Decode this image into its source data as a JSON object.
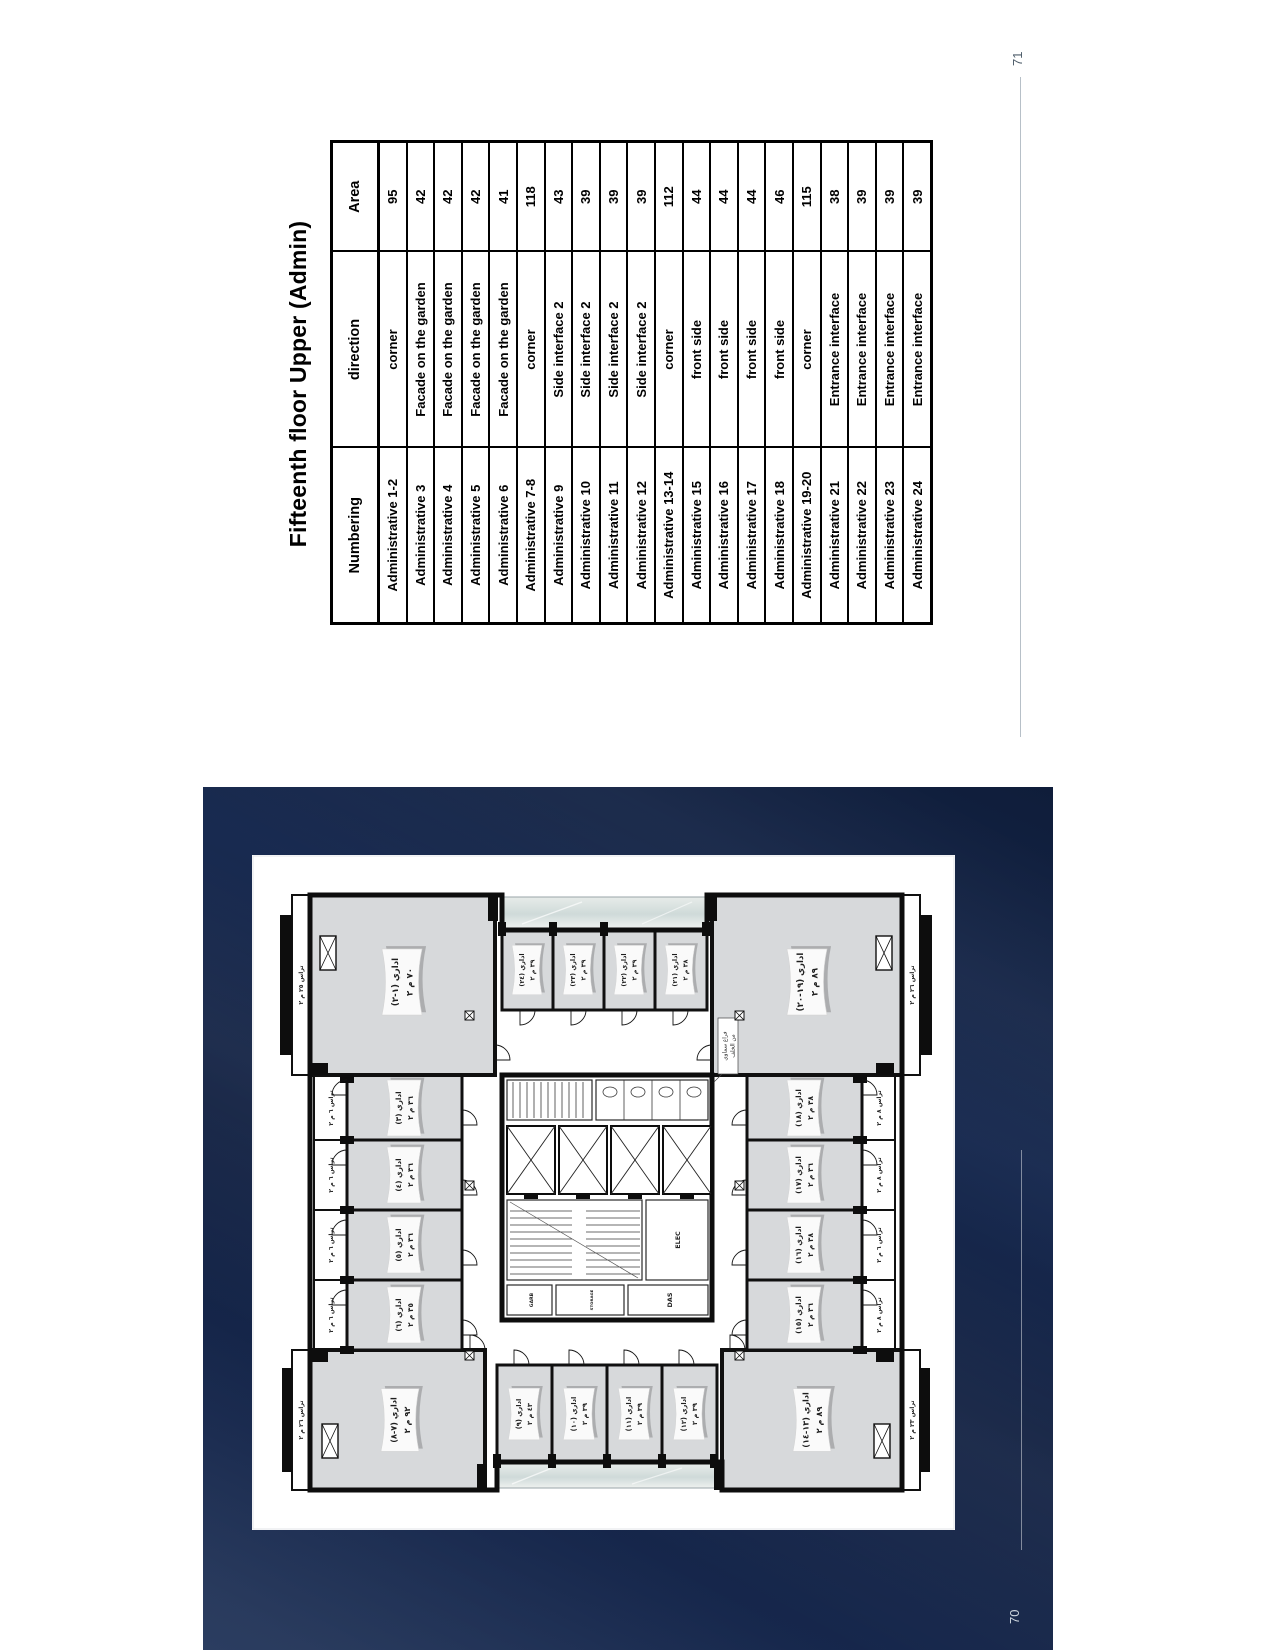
{
  "page71": {
    "page_number": "71",
    "title": "Fifteenth floor Upper (Admin)",
    "table": {
      "headers": [
        "Numbering",
        "direction",
        "Area"
      ],
      "rows": [
        [
          "Administrative 1-2",
          "corner",
          "95"
        ],
        [
          "Administrative 3",
          "Facade on the garden",
          "42"
        ],
        [
          "Administrative 4",
          "Facade on the garden",
          "42"
        ],
        [
          "Administrative 5",
          "Facade on the garden",
          "42"
        ],
        [
          "Administrative 6",
          "Facade on the garden",
          "41"
        ],
        [
          "Administrative 7-8",
          "corner",
          "118"
        ],
        [
          "Administrative 9",
          "Side interface 2",
          "43"
        ],
        [
          "Administrative 10",
          "Side interface 2",
          "39"
        ],
        [
          "Administrative 11",
          "Side interface 2",
          "39"
        ],
        [
          "Administrative 12",
          "Side interface 2",
          "39"
        ],
        [
          "Administrative 13-14",
          "corner",
          "112"
        ],
        [
          "Administrative 15",
          "front side",
          "44"
        ],
        [
          "Administrative 16",
          "front side",
          "44"
        ],
        [
          "Administrative 17",
          "front side",
          "44"
        ],
        [
          "Administrative 18",
          "front side",
          "46"
        ],
        [
          "Administrative 19-20",
          "corner",
          "115"
        ],
        [
          "Administrative 21",
          "Entrance interface",
          "38"
        ],
        [
          "Administrative 22",
          "Entrance interface",
          "39"
        ],
        [
          "Administrative 23",
          "Entrance interface",
          "39"
        ],
        [
          "Administrative 24",
          "Entrance interface",
          "39"
        ]
      ]
    }
  },
  "page70": {
    "page_number": "70",
    "plan": {
      "rooms": [
        {
          "name": "اداري (٧-٨)",
          "area": "٩٢ م ٢"
        },
        {
          "name": "اداري (٦)",
          "area": "٣٥ م ٢"
        },
        {
          "name": "اداري (٥)",
          "area": "٣٦ م ٢"
        },
        {
          "name": "اداري (٤)",
          "area": "٣٦ م ٢"
        },
        {
          "name": "اداري (٣)",
          "area": "٣٦ م ٢"
        },
        {
          "name": "اداري (١-٢)",
          "area": "٧٠ م ٢"
        },
        {
          "name": "اداري (٩)",
          "area": "٤٣ م ٢"
        },
        {
          "name": "اداري (١٠)",
          "area": "٣٩ م ٢"
        },
        {
          "name": "اداري (١١)",
          "area": "٣٩ م ٢"
        },
        {
          "name": "اداري (١٢)",
          "area": "٣٩ م ٢"
        },
        {
          "name": "اداري (٢٤)",
          "area": "٣٩ م ٢"
        },
        {
          "name": "اداري (٢٣)",
          "area": "٣٩ م ٢"
        },
        {
          "name": "اداري (٢٢)",
          "area": "٣٩ م ٢"
        },
        {
          "name": "اداري (٢١)",
          "area": "٣٨ م ٢"
        },
        {
          "name": "اداري (١٣-١٤)",
          "area": "٨٩ م ٢"
        },
        {
          "name": "اداري (١٥)",
          "area": "٣٦ م ٢"
        },
        {
          "name": "اداري (١٦)",
          "area": "٣٨ م ٢"
        },
        {
          "name": "اداري (١٧)",
          "area": "٣٦ م ٢"
        },
        {
          "name": "اداري (١٨)",
          "area": "٣٨ م ٢"
        },
        {
          "name": "اداري (١٩-٢٠)",
          "area": "٨٩ م ٢"
        }
      ],
      "terraces": [
        "تراس ٢٦ م ٢",
        "تراس ٦ م ٢",
        "تراس ٦ م ٢",
        "تراس ٦ م ٢",
        "تراس ٦ م ٢",
        "تراس ٢٥ م ٢",
        "تراس ٢٣ م ٢",
        "تراس ٨ م ٢",
        "تراس ٦ م ٢",
        "تراس ٨ م ٢",
        "تراس ٨ م ٢",
        "تراس ٢٦ م ٢"
      ],
      "core_labels": [
        "GARB",
        "STORAGE",
        "DAS",
        "ELEC"
      ],
      "annotation": [
        "فراغ سماوي",
        "من الخلف"
      ]
    }
  }
}
